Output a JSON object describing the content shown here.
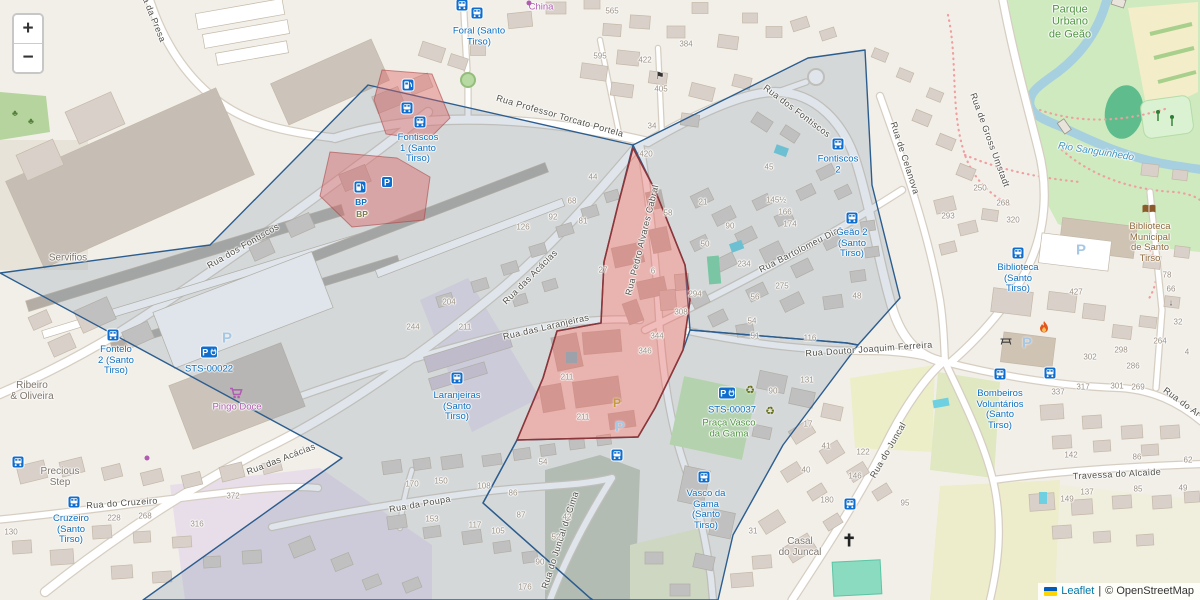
{
  "controls": {
    "zoom_in": "+",
    "zoom_out": "−"
  },
  "attribution": {
    "flag_top": "#005bbb",
    "flag_bottom": "#ffd500",
    "leaflet": "Leaflet",
    "separator": "|",
    "copyright": "© OpenStreetMap"
  },
  "overlays": {
    "blue": {
      "stroke": "#2c5d8f",
      "fill": "rgba(110,135,160,0.22)",
      "cells": [
        "0,273 210,245 368,85 633,145 618,205 604,262 601,323 557,331 543,378 517,440 483,503 590,598 593,600 143,600 283,500 342,458",
        "633,145 808,58 865,50 872,185 900,298 858,345 847,343 690,330 685,265 655,190",
        "690,330 847,343 858,345 783,445 733,535 718,600 593,600 590,598 483,503 517,440 638,437 655,408 683,350"
      ]
    },
    "red": {
      "stroke": "#8d3538",
      "fill": "rgba(222,96,96,0.42)",
      "minor_stroke": "rgba(165,62,62,0.55)",
      "areas": [
        {
          "pts": "633,148 655,190 685,265 690,300 683,350 655,408 638,437 517,440 543,378 557,331 601,323 604,262 618,205",
          "minor": false
        },
        {
          "pts": "382,70 432,74 450,118 428,140 386,134 374,100",
          "minor": true
        },
        {
          "pts": "330,152 397,158 430,177 424,220 352,227 320,196",
          "minor": true
        }
      ]
    }
  },
  "streets": [
    {
      "t": "Rua da Presa",
      "x": 152,
      "y": 14,
      "r": 68
    },
    {
      "t": "Rua Professor Torcato Portela",
      "x": 560,
      "y": 116,
      "r": 16
    },
    {
      "t": "Rua dos Fontiscos",
      "x": 797,
      "y": 111,
      "r": 37
    },
    {
      "t": "Rua dos Fontiscos",
      "x": 243,
      "y": 246,
      "r": -30
    },
    {
      "t": "Rua das Acácias",
      "x": 530,
      "y": 277,
      "r": -45
    },
    {
      "t": "Rua das Acácias",
      "x": 281,
      "y": 459,
      "r": -21
    },
    {
      "t": "Rua das Laranjeiras",
      "x": 546,
      "y": 327,
      "r": -13
    },
    {
      "t": "Rua Pedro Alvares Cabral",
      "x": 642,
      "y": 240,
      "r": -76
    },
    {
      "t": "Rua Bartolomeu Dias",
      "x": 801,
      "y": 249,
      "r": -27
    },
    {
      "t": "Rua Doutor Joaquim Ferreira",
      "x": 869,
      "y": 349,
      "r": -4
    },
    {
      "t": "Rua do Cruzeiro",
      "x": 122,
      "y": 503,
      "r": -4
    },
    {
      "t": "Rua da Poupa",
      "x": 420,
      "y": 504,
      "r": -10
    },
    {
      "t": "Rua do Juncal de Cima",
      "x": 560,
      "y": 540,
      "r": -72
    },
    {
      "t": "Rua do Juncal",
      "x": 888,
      "y": 450,
      "r": -60
    },
    {
      "t": "Rua de Gross Umstadt",
      "x": 990,
      "y": 140,
      "r": 70
    },
    {
      "t": "Rua de Celanova",
      "x": 905,
      "y": 158,
      "r": 72
    },
    {
      "t": "Travessa do Alcaide",
      "x": 1117,
      "y": 474,
      "r": -3
    },
    {
      "t": "Rua do Ar",
      "x": 1182,
      "y": 402,
      "r": 36
    }
  ],
  "places": [
    {
      "t": "Foral (Santo\nTirso)",
      "x": 479,
      "y": 37
    },
    {
      "t": "Fontiscos\n1 (Santo\nTirso)",
      "x": 418,
      "y": 149
    },
    {
      "t": "Fontiscos\n2",
      "x": 838,
      "y": 165
    },
    {
      "t": "Fontelo\n2 (Santo\nTirso)",
      "x": 116,
      "y": 361
    },
    {
      "t": "STS-00022",
      "x": 209,
      "y": 370
    },
    {
      "t": "Laranjeiras\n(Santo\nTirso)",
      "x": 457,
      "y": 407
    },
    {
      "t": "Geão 2\n(Santo\nTirso)",
      "x": 852,
      "y": 244
    },
    {
      "t": "Cruzeiro\n(Santo\nTirso)",
      "x": 71,
      "y": 530
    },
    {
      "t": "Vasco da\nGama\n(Santo\nTirso)",
      "x": 706,
      "y": 510
    },
    {
      "t": "Biblioteca\n(Santo\nTirso)",
      "x": 1018,
      "y": 279
    },
    {
      "t": "Bombeiros\nVoluntários\n(Santo\nTirso)",
      "x": 1000,
      "y": 410
    },
    {
      "t": "STS-00037",
      "x": 732,
      "y": 411
    }
  ],
  "pois": [
    {
      "t": "China",
      "x": 541,
      "y": 8,
      "c": "purple"
    },
    {
      "t": "Pingo Doce",
      "x": 237,
      "y": 408,
      "c": "purple"
    },
    {
      "t": "Praça Vasco\nda Gama",
      "x": 729,
      "y": 429,
      "c": "green"
    },
    {
      "t": "Parque\nUrbano\nde Geão",
      "x": 1070,
      "y": 22,
      "c": "green",
      "s": 11
    },
    {
      "t": "Biblioteca\nMunicipal\nde Santo\nTirso",
      "x": 1150,
      "y": 243,
      "c": "brown"
    },
    {
      "t": "Rio Sanguinhedo",
      "x": 1096,
      "y": 152,
      "c": "water",
      "r": 9
    },
    {
      "t": "Servifios",
      "x": 68,
      "y": 258,
      "c": "gray"
    },
    {
      "t": "Ribeiro\n& Oliveira",
      "x": 32,
      "y": 391,
      "c": "gray"
    },
    {
      "t": "Precious\nStep",
      "x": 60,
      "y": 477,
      "c": "gray"
    },
    {
      "t": "Casal\ndo Juncal",
      "x": 800,
      "y": 547,
      "c": "gray"
    },
    {
      "t": "BP",
      "x": 361,
      "y": 203,
      "c": "blue-sm"
    },
    {
      "t": "BP",
      "x": 362,
      "y": 215,
      "c": "olive"
    }
  ],
  "house_numbers": [
    [
      "565",
      612,
      12
    ],
    [
      "384",
      686,
      45
    ],
    [
      "422",
      645,
      61
    ],
    [
      "595",
      600,
      57
    ],
    [
      "405",
      661,
      90
    ],
    [
      "34",
      652,
      127
    ],
    [
      "420",
      646,
      155
    ],
    [
      "45",
      769,
      168
    ],
    [
      "145½",
      776,
      201
    ],
    [
      "166",
      785,
      213
    ],
    [
      "174",
      790,
      225
    ],
    [
      "21",
      703,
      203
    ],
    [
      "90",
      730,
      227
    ],
    [
      "50",
      705,
      245
    ],
    [
      "234",
      744,
      265
    ],
    [
      "275",
      782,
      287
    ],
    [
      "294",
      695,
      295
    ],
    [
      "48",
      857,
      297
    ],
    [
      "56",
      755,
      298
    ],
    [
      "54",
      752,
      322
    ],
    [
      "51",
      755,
      337
    ],
    [
      "116",
      810,
      339
    ],
    [
      "58",
      668,
      214
    ],
    [
      "44",
      593,
      178
    ],
    [
      "68",
      572,
      202
    ],
    [
      "92",
      553,
      218
    ],
    [
      "81",
      583,
      222
    ],
    [
      "126",
      523,
      228
    ],
    [
      "27",
      603,
      271
    ],
    [
      "6",
      653,
      272
    ],
    [
      "308",
      681,
      313
    ],
    [
      "204",
      449,
      303
    ],
    [
      "244",
      413,
      328
    ],
    [
      "211",
      465,
      328
    ],
    [
      "211",
      567,
      378
    ],
    [
      "211",
      583,
      418
    ],
    [
      "344",
      657,
      337
    ],
    [
      "346",
      645,
      352
    ],
    [
      "372",
      233,
      497
    ],
    [
      "316",
      197,
      525
    ],
    [
      "268",
      145,
      517
    ],
    [
      "228",
      114,
      519
    ],
    [
      "130",
      11,
      533
    ],
    [
      "170",
      412,
      485
    ],
    [
      "150",
      441,
      482
    ],
    [
      "108",
      484,
      487
    ],
    [
      "54",
      543,
      463
    ],
    [
      "86",
      513,
      494
    ],
    [
      "153",
      432,
      520
    ],
    [
      "117",
      475,
      526
    ],
    [
      "105",
      498,
      532
    ],
    [
      "87",
      521,
      516
    ],
    [
      "42",
      567,
      518
    ],
    [
      "52",
      556,
      538
    ],
    [
      "90",
      540,
      563
    ],
    [
      "176",
      525,
      588
    ],
    [
      "31",
      753,
      532
    ],
    [
      "90",
      773,
      392
    ],
    [
      "17",
      808,
      425
    ],
    [
      "131",
      807,
      381
    ],
    [
      "41",
      826,
      447
    ],
    [
      "122",
      863,
      453
    ],
    [
      "40",
      806,
      471
    ],
    [
      "146",
      855,
      477
    ],
    [
      "95",
      905,
      504
    ],
    [
      "180",
      827,
      501
    ],
    [
      "427",
      1076,
      293
    ],
    [
      "302",
      1090,
      358
    ],
    [
      "298",
      1121,
      351
    ],
    [
      "286",
      1133,
      367
    ],
    [
      "264",
      1160,
      342
    ],
    [
      "4",
      1187,
      353
    ],
    [
      "66",
      1171,
      290
    ],
    [
      "78",
      1167,
      276
    ],
    [
      "32",
      1178,
      323
    ],
    [
      "317",
      1083,
      388
    ],
    [
      "301",
      1117,
      387
    ],
    [
      "269",
      1138,
      388
    ],
    [
      "337",
      1058,
      393
    ],
    [
      "142",
      1071,
      456
    ],
    [
      "86",
      1137,
      458
    ],
    [
      "62",
      1188,
      461
    ],
    [
      "149",
      1067,
      500
    ],
    [
      "137",
      1087,
      493
    ],
    [
      "85",
      1138,
      490
    ],
    [
      "49",
      1183,
      489
    ],
    [
      "293",
      948,
      217
    ],
    [
      "268",
      1003,
      204
    ],
    [
      "250",
      980,
      189
    ],
    [
      "320",
      1013,
      221
    ]
  ],
  "icons": [
    [
      "bus",
      462,
      5
    ],
    [
      "bus",
      477,
      13
    ],
    [
      "bus",
      407,
      108
    ],
    [
      "bus",
      420,
      122
    ],
    [
      "bus",
      838,
      144
    ],
    [
      "bus",
      852,
      218
    ],
    [
      "bus",
      113,
      335
    ],
    [
      "bus",
      457,
      378
    ],
    [
      "bus",
      617,
      455
    ],
    [
      "bus",
      704,
      477
    ],
    [
      "bus",
      18,
      462
    ],
    [
      "bus",
      74,
      502
    ],
    [
      "bus",
      1018,
      253
    ],
    [
      "bus",
      1000,
      374
    ],
    [
      "bus",
      1050,
      373
    ],
    [
      "bus",
      850,
      504
    ],
    [
      "fuel",
      408,
      85
    ],
    [
      "fuel",
      360,
      187
    ],
    [
      "parkbox",
      387,
      182
    ],
    [
      "charge",
      209,
      352
    ],
    [
      "charge",
      727,
      393
    ],
    [
      "ghostP",
      227,
      338
    ],
    [
      "ghostP",
      1081,
      250
    ],
    [
      "ghostP",
      1027,
      343
    ],
    [
      "ghostP",
      620,
      427
    ],
    [
      "amberP",
      617,
      403
    ],
    [
      "cart",
      236,
      393
    ],
    [
      "book",
      1149,
      209
    ],
    [
      "recycle",
      750,
      391
    ],
    [
      "recycle",
      770,
      412
    ],
    [
      "flame",
      1044,
      327
    ],
    [
      "cross",
      849,
      540
    ],
    [
      "picnic",
      1006,
      341
    ],
    [
      "flag",
      660,
      77
    ],
    [
      "arrow",
      1171,
      303
    ],
    [
      "dot",
      147,
      458
    ],
    [
      "dot",
      529,
      3
    ]
  ]
}
